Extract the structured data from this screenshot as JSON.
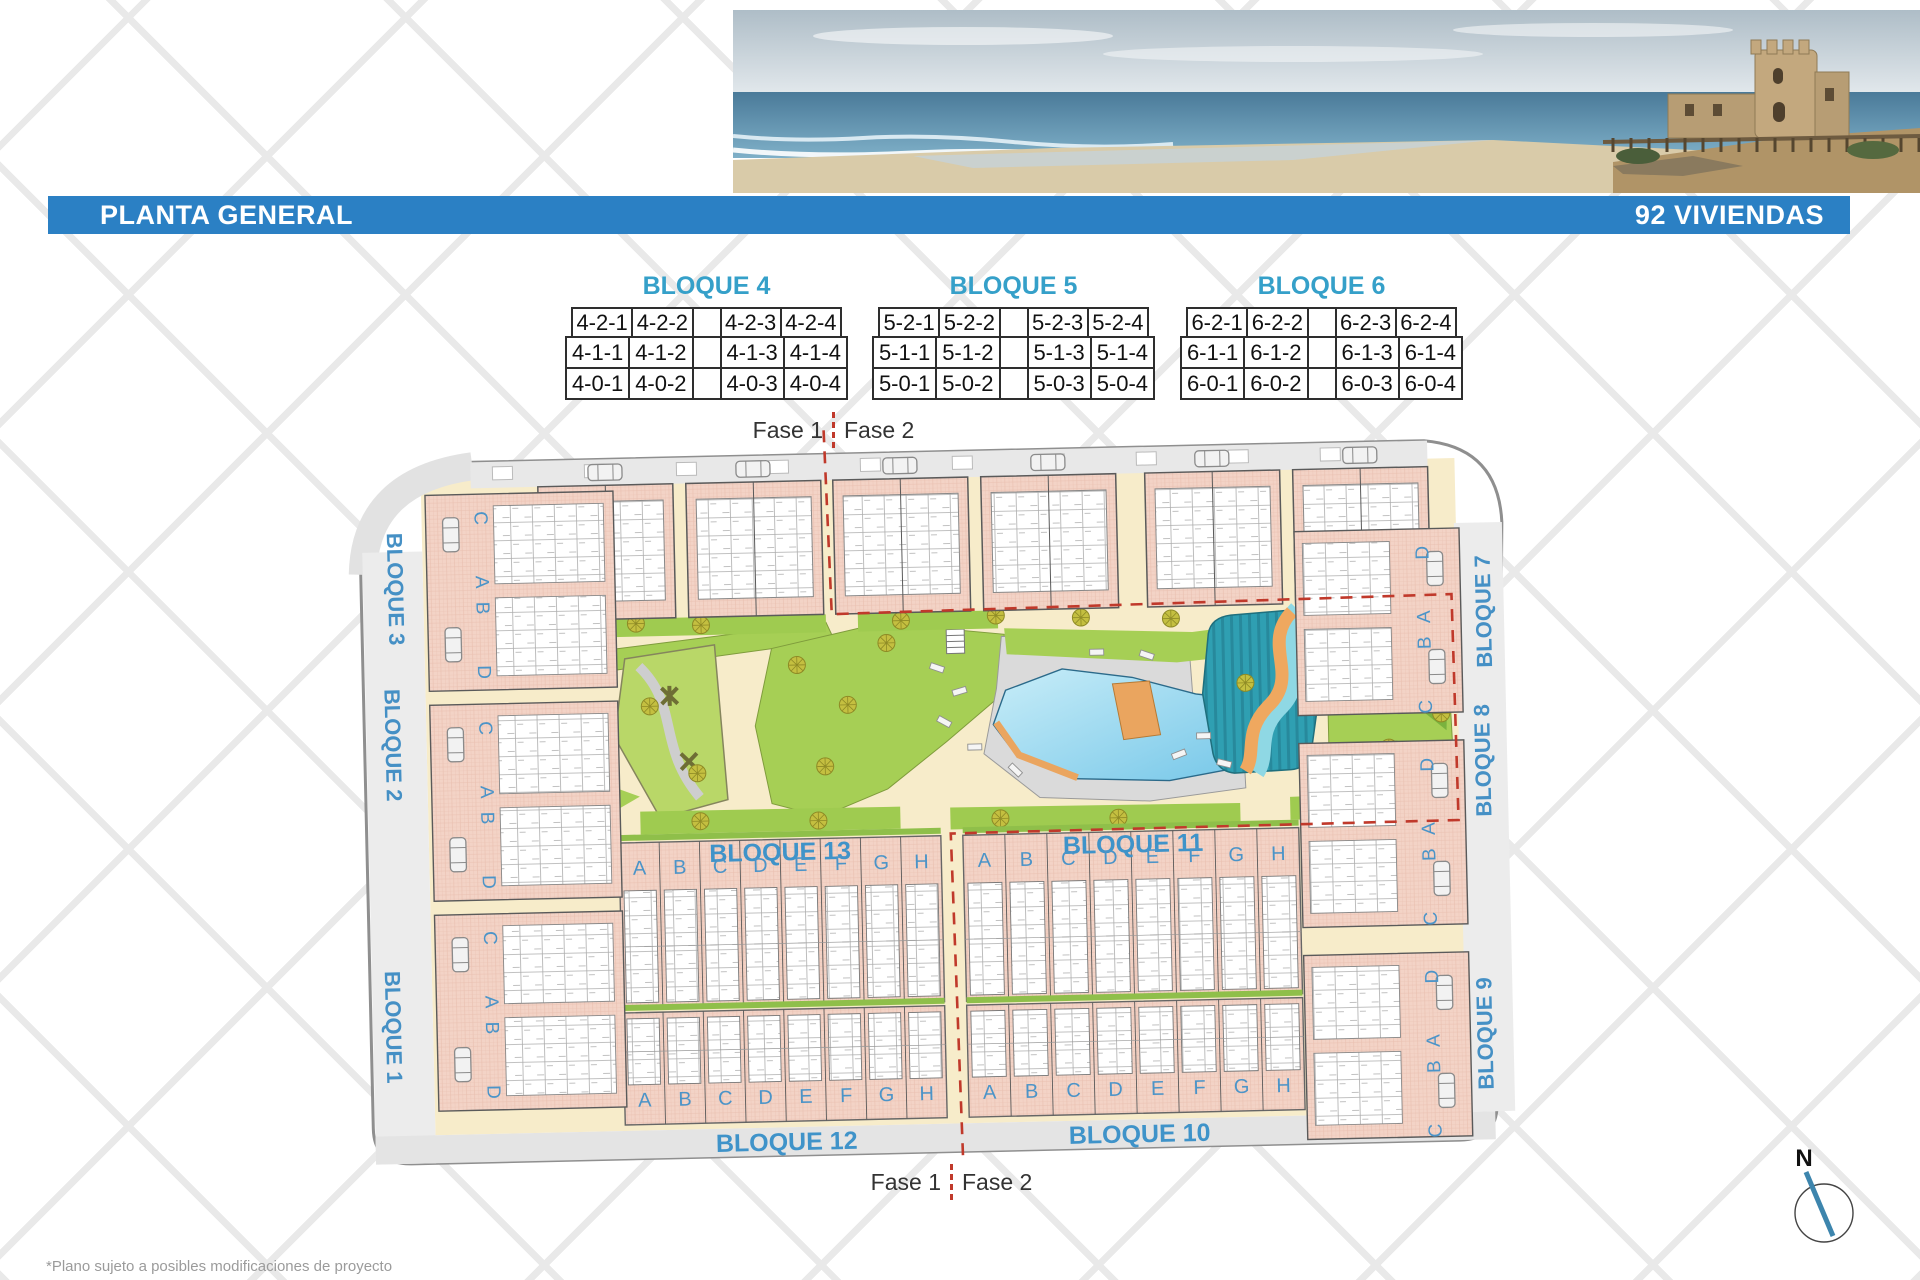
{
  "header": {
    "title_left": "PLANTA GENERAL",
    "title_right": "92 VIVIENDAS"
  },
  "tables": [
    {
      "title": "BLOQUE 4",
      "rows": [
        [
          "4-2-1",
          "4-2-2",
          "4-2-3",
          "4-2-4"
        ],
        [
          "4-1-1",
          "4-1-2",
          "4-1-3",
          "4-1-4"
        ],
        [
          "4-0-1",
          "4-0-2",
          "4-0-3",
          "4-0-4"
        ]
      ]
    },
    {
      "title": "BLOQUE 5",
      "rows": [
        [
          "5-2-1",
          "5-2-2",
          "5-2-3",
          "5-2-4"
        ],
        [
          "5-1-1",
          "5-1-2",
          "5-1-3",
          "5-1-4"
        ],
        [
          "5-0-1",
          "5-0-2",
          "5-0-3",
          "5-0-4"
        ]
      ]
    },
    {
      "title": "BLOQUE 6",
      "rows": [
        [
          "6-2-1",
          "6-2-2",
          "6-2-3",
          "6-2-4"
        ],
        [
          "6-1-1",
          "6-1-2",
          "6-1-3",
          "6-1-4"
        ],
        [
          "6-0-1",
          "6-0-2",
          "6-0-3",
          "6-0-4"
        ]
      ]
    }
  ],
  "phase": {
    "fase1": "Fase 1",
    "fase2": "Fase 2"
  },
  "plan": {
    "left_blocks": [
      "BLOQUE 3",
      "BLOQUE 2",
      "BLOQUE 1"
    ],
    "right_blocks": [
      "BLOQUE 7",
      "BLOQUE 8",
      "BLOQUE 9"
    ],
    "center_top_blocks": [
      "BLOQUE 13",
      "BLOQUE 11"
    ],
    "center_bottom_blocks": [
      "BLOQUE 12",
      "BLOQUE 10"
    ],
    "row_letters": [
      "A",
      "B",
      "C",
      "D",
      "E",
      "F",
      "G",
      "H"
    ],
    "left_unit_letters": [
      "C",
      "A",
      "B",
      "D"
    ],
    "right_unit_letters": [
      "D",
      "A",
      "B",
      "C"
    ]
  },
  "compass": {
    "north_label": "N"
  },
  "footnote": "*Plano sujeto a posibles modificaciones de proyecto",
  "colors": {
    "bar_blue": "#2b80c4",
    "label_blue": "#4590c5",
    "table_title_teal": "#35a0c9",
    "building_pink": "#f3d3c6",
    "green": "#a6cf55",
    "pool_blue": "#8ed4ee",
    "splash_teal": "#2f9fb2",
    "orange": "#eaa55f",
    "promenade_beige": "#f7ecca",
    "phase_red": "#c0392b",
    "road_grey": "#ececec"
  }
}
